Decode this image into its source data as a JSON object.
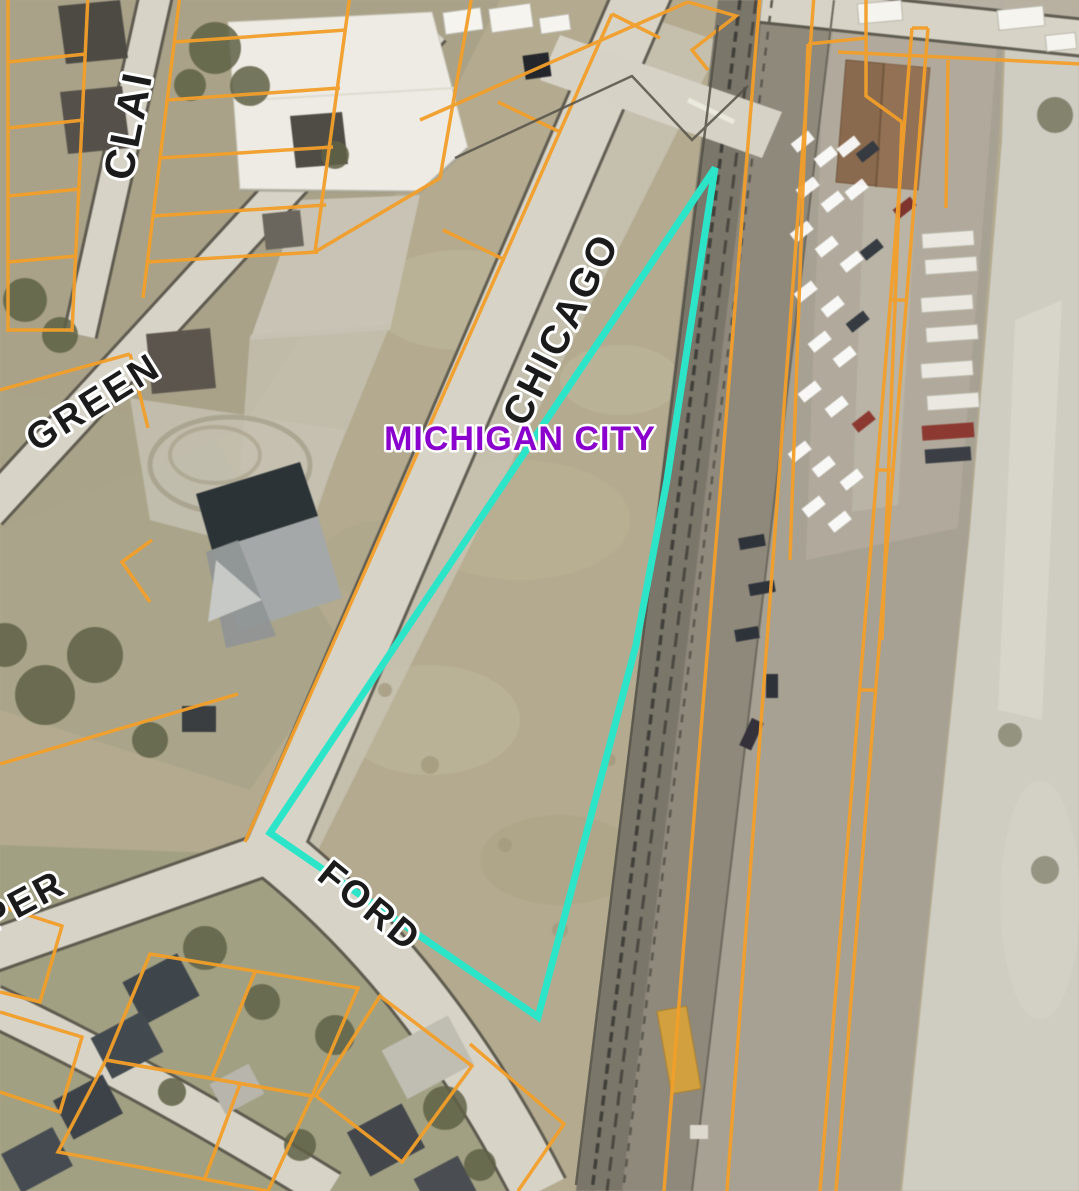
{
  "map": {
    "kind": "aerial-parcel-viewer",
    "city_label": {
      "text": "MICHIGAN CITY",
      "color": "#8a00cc"
    },
    "street_label_color": "#1b1b1b",
    "street_labels": [
      {
        "text": "CHICAGO"
      },
      {
        "text": "GREEN"
      },
      {
        "text": "CLAI"
      },
      {
        "text": "FORD"
      },
      {
        "text": "PER"
      }
    ],
    "highlight_parcel": {
      "points": "715,168 667,480 636,645 538,1017 270,833",
      "stroke": "#2ce5c9",
      "stroke_width": 7
    },
    "parcel_line_color": "#f29f2a"
  }
}
